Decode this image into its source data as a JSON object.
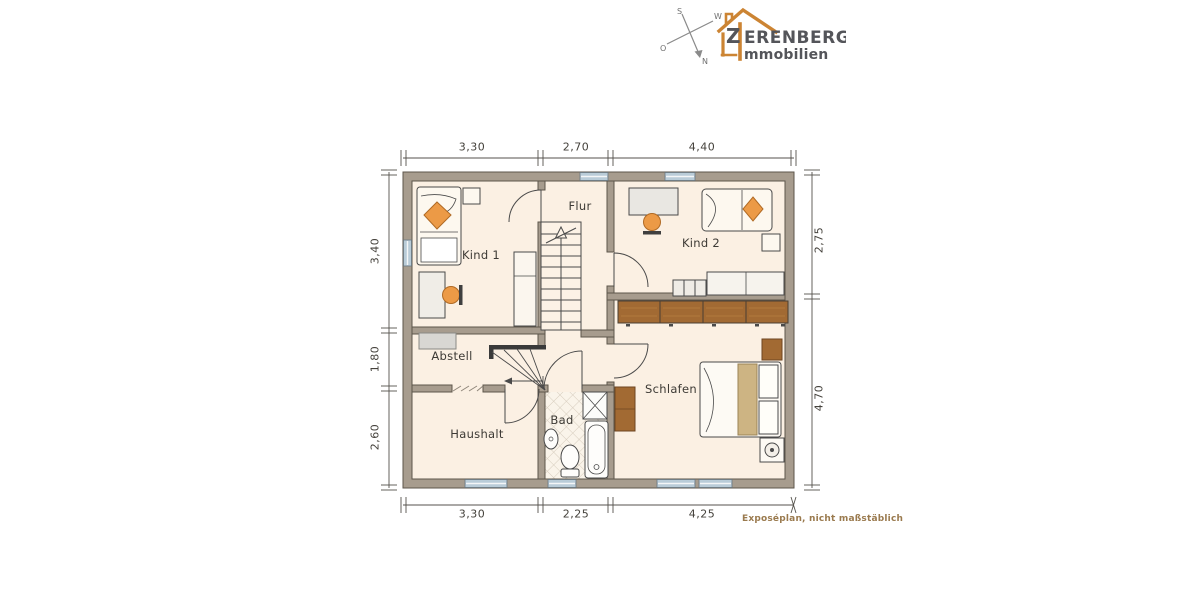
{
  "brand": {
    "initial": "Z",
    "name_rest": "ERENBERG",
    "subtitle": "mmobilien",
    "orange": "#cc8433",
    "text_color": "#54555a"
  },
  "compass": {
    "top": "S",
    "bottom": "N",
    "left": "O",
    "right": "W"
  },
  "plan": {
    "rooms": {
      "kind1": "Kind 1",
      "flur": "Flur",
      "kind2": "Kind 2",
      "abstell": "Abstell",
      "schlafen": "Schlafen",
      "haushalt": "Haushalt",
      "bad": "Bad"
    },
    "dimensions": {
      "top": [
        "3,30",
        "2,70",
        "4,40"
      ],
      "left": [
        "3,40",
        "1,80",
        "2,60"
      ],
      "right": [
        "2,75",
        "4,70"
      ],
      "bottom": [
        "3,30",
        "2,25",
        "4,25"
      ]
    },
    "footnote": "Exposéplan, nicht maßstäblich"
  },
  "colors": {
    "wall": "#a79c8e",
    "wall_edge": "#5d564b",
    "floor": "#fbf0e3",
    "window": "#b9ccd8",
    "accent_orange": "#ec9a46",
    "wood_brown": "#a26a33",
    "duvet_tan": "#cdb483"
  }
}
